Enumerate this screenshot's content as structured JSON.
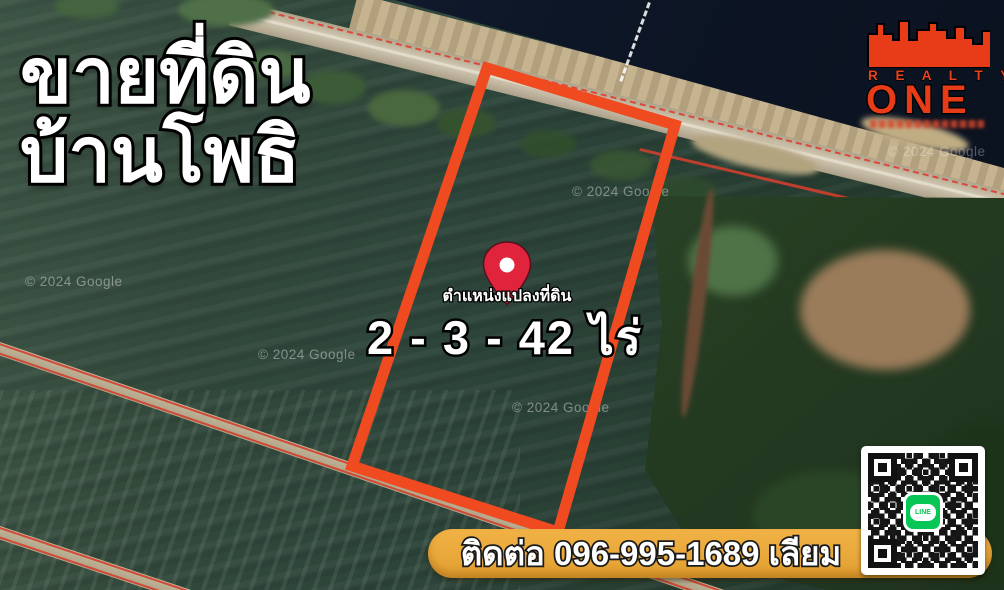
{
  "poster": {
    "title_line1": "ขายที่ดิน",
    "title_line2": "บ้านโพธิ",
    "pin_label": "ตำแหน่งแปลงที่ดิน",
    "area_text": "2 - 3 - 42 ไร่",
    "contact_text": "ติดต่อ 096-995-1689 เลียม"
  },
  "logo": {
    "realty": "R E A L T Y",
    "one": "ONE"
  },
  "qr": {
    "line_label": "LINE"
  },
  "map": {
    "watermark": "© 2024 Google"
  },
  "plot": {
    "polygon_points": "487,68 675,125 558,532 352,466"
  },
  "colors": {
    "plot_outline": "#f04a20",
    "pin": "#e0243c",
    "banner": "#e8a73c",
    "logo_red": "#e8441f",
    "line_green": "#06c755",
    "water": "#0d1626"
  }
}
